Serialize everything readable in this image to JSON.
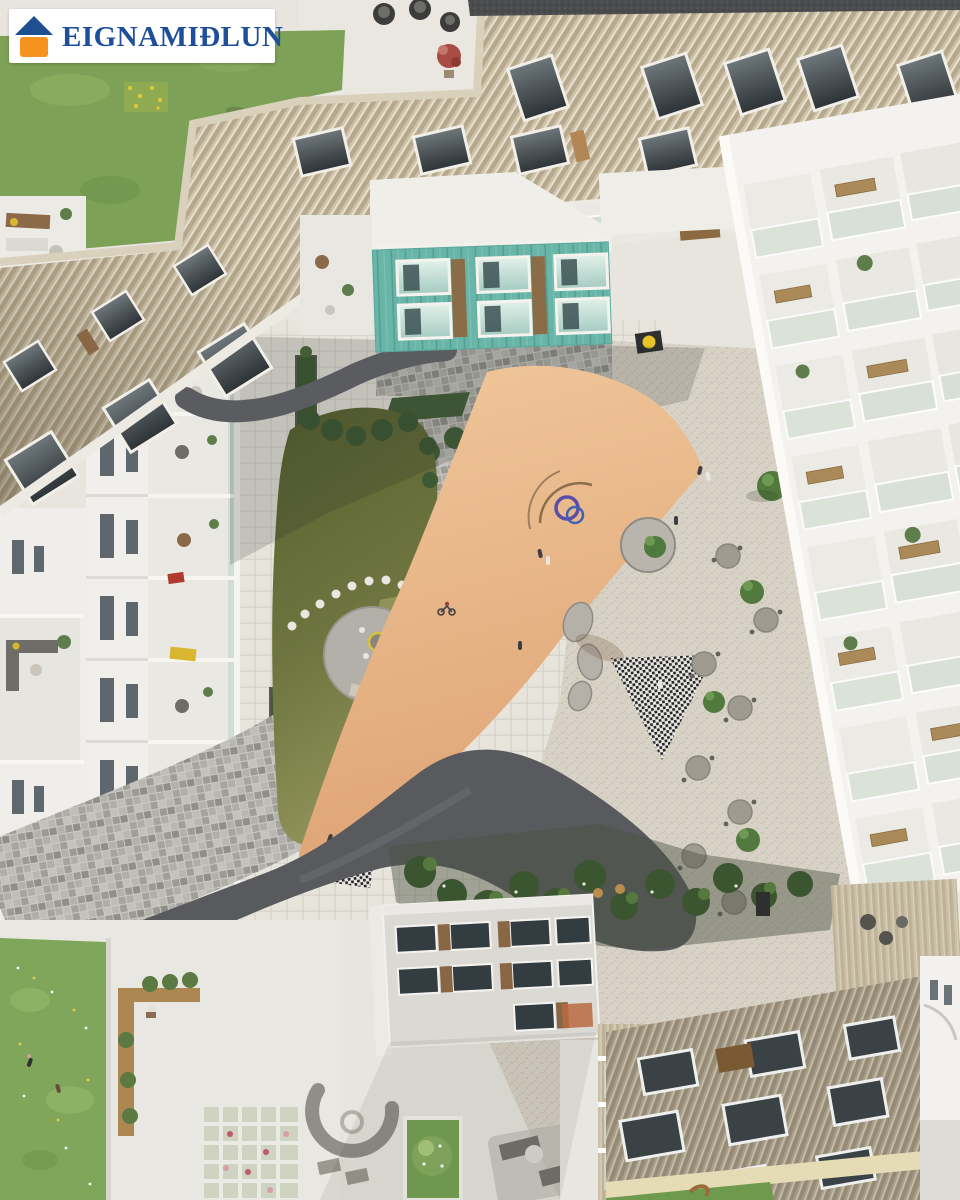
{
  "logo": {
    "text": "EIGNAMIÐLUN",
    "icon": "house-logo-icon",
    "roof_color": "#1d4f91",
    "square_color": "#f59220",
    "text_color": "#1e4f9a",
    "background": "#ffffff"
  },
  "scene": {
    "type": "aerial-architectural-rendering",
    "title": "Bird's-eye rendering of a residential courtyard between apartment buildings",
    "areas": [
      {
        "name": "lawn-top-left",
        "color": "#7da156"
      },
      {
        "name": "wood-slat-facade-top",
        "color": "#cec3aa"
      },
      {
        "name": "copper-teal-building",
        "color": "#69b6a9"
      },
      {
        "name": "white-apartment-left",
        "color": "#f0efeb"
      },
      {
        "name": "white-apartment-right",
        "color": "#f3f2ee"
      },
      {
        "name": "courtyard-lawn",
        "color": "#6d743f"
      },
      {
        "name": "stone-paving-band",
        "color": "#aba9a3"
      },
      {
        "name": "orange-playground-triangle",
        "color": "#e7b487"
      },
      {
        "name": "cafe-plaza",
        "color": "#d8d2c6"
      },
      {
        "name": "asphalt-path",
        "color": "#595a5e"
      },
      {
        "name": "garden-beds",
        "color": "#3c5531"
      },
      {
        "name": "meadow-bottom-left",
        "color": "#7fa65a"
      },
      {
        "name": "roof-terraces-bottom",
        "color": "#e9e7e1"
      },
      {
        "name": "wood-slat-facade-bottom",
        "color": "#a89e8a"
      }
    ]
  }
}
